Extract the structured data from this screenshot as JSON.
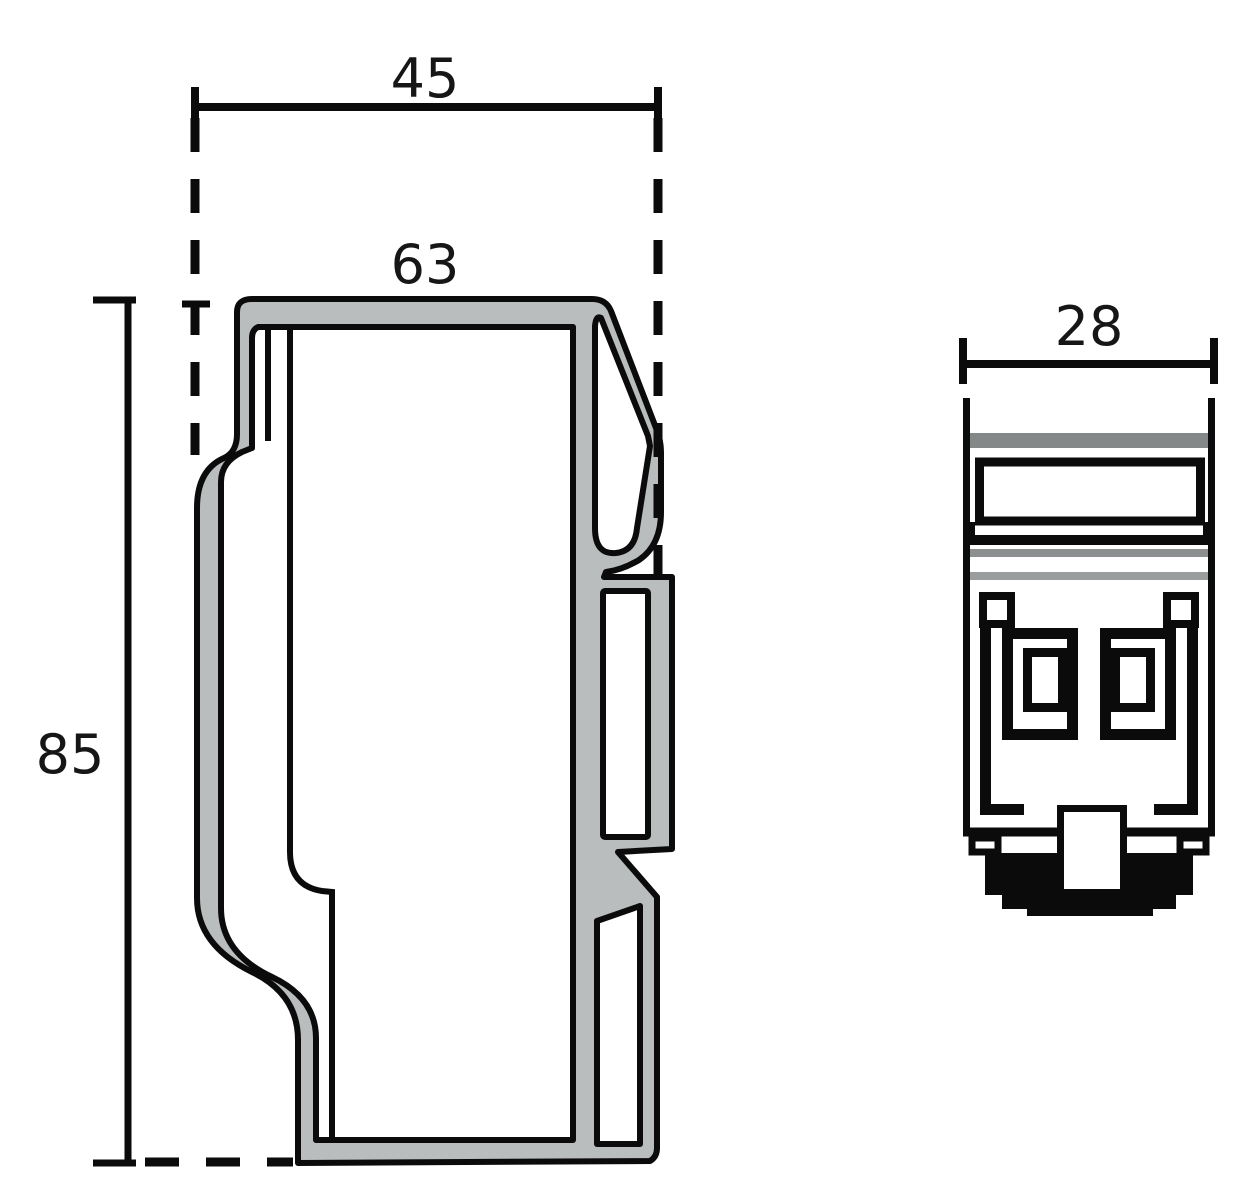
{
  "drawing": {
    "title": "profile-technical-drawing",
    "left_profile": {
      "name": "main-profile-cross-section",
      "dims": {
        "overall_width": "45",
        "top_width": "63",
        "height": "85"
      }
    },
    "right_profile": {
      "name": "end-cap-front-view",
      "dims": {
        "width": "28"
      }
    },
    "colors": {
      "body_fill": "#b9bdbe",
      "outline": "#0b0b0b",
      "band_dark": "#858889",
      "band_mid": "#8d9091",
      "band_light": "#9a9d9e"
    }
  }
}
